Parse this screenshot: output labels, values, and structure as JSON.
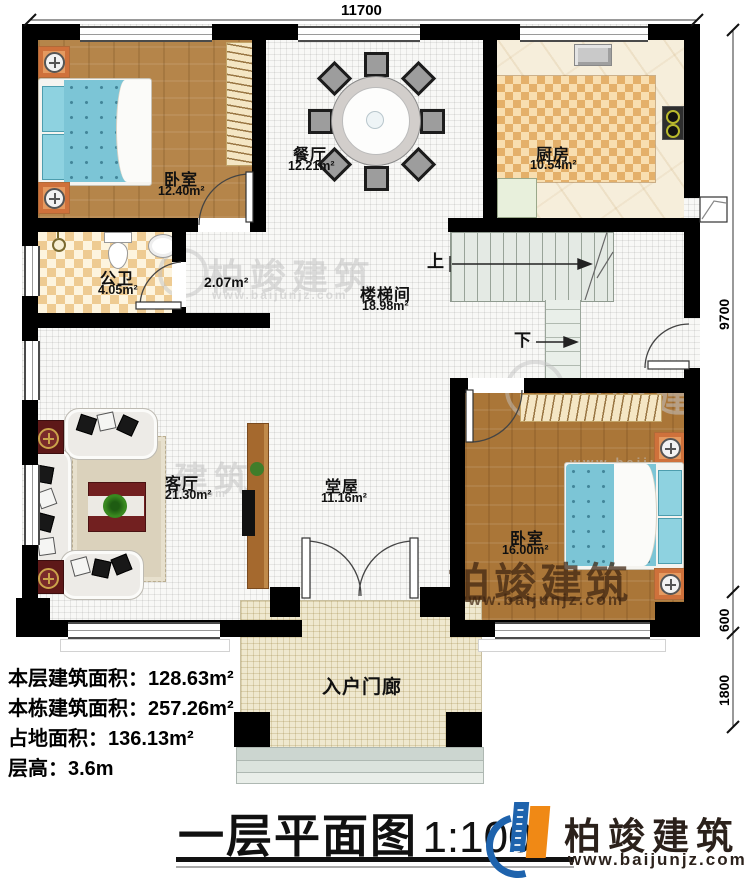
{
  "plan": {
    "dim_top": "11700",
    "dim_right_upper": "9700",
    "dim_right_mid": "600",
    "dim_right_lower": "1800"
  },
  "rooms": {
    "bedroom_left": {
      "name": "卧室",
      "area": "12.40m²"
    },
    "dining": {
      "name": "餐厅",
      "area": "12.21m²"
    },
    "kitchen": {
      "name": "厨房",
      "area": "10.54m²"
    },
    "bathroom": {
      "name": "公卫",
      "area": "4.05m²"
    },
    "corridor": {
      "area": "2.07m²"
    },
    "stairwell": {
      "name": "楼梯间",
      "area": "18.98m²"
    },
    "living": {
      "name": "客厅",
      "area": "21.30m²"
    },
    "hall": {
      "name": "堂屋",
      "area": "11.16m²"
    },
    "bedroom_right": {
      "name": "卧室",
      "area": "16.00m²"
    },
    "porch": {
      "name": "入户门廊"
    }
  },
  "stairs": {
    "up": "上",
    "down": "下"
  },
  "stats": [
    {
      "label": "本层建筑面积：",
      "value": "128.63m²"
    },
    {
      "label": "本栋建筑面积：",
      "value": "257.26m²"
    },
    {
      "label": "占地面积：",
      "value": "136.13m²"
    },
    {
      "label": "层高：",
      "value": "3.6m"
    }
  ],
  "title": {
    "text": "一层平面图",
    "scale": "1:100"
  },
  "brand": {
    "name": "柏竣建筑",
    "url": "www.baijunjz.com"
  },
  "watermark": {
    "name": "柏竣建筑",
    "url": "www.baijunjz.com"
  },
  "colors": {
    "wall": "#000000",
    "wood1": "#b5854a",
    "wood2": "#aa7638",
    "bedquilt": "#7cc5d6",
    "bedpillow": "#8ed2e0",
    "tileA": "#eecb92",
    "tileB": "#fdf4de",
    "rugA": "#e4b06a",
    "rugB": "#f8deb0",
    "marble": "#f6eedb",
    "stair": "#e4eae4",
    "porch": "#efe8cf",
    "nstand": "#e59a60",
    "sofa": "#edebe7",
    "redcab": "#5d1818",
    "ctable": "#722020",
    "carpet": "#dbd2bc",
    "tvcab": "#a5692e",
    "accent_blue": "#1e63ad",
    "accent_orange": "#f08915",
    "brand_dark": "#2b211b"
  }
}
